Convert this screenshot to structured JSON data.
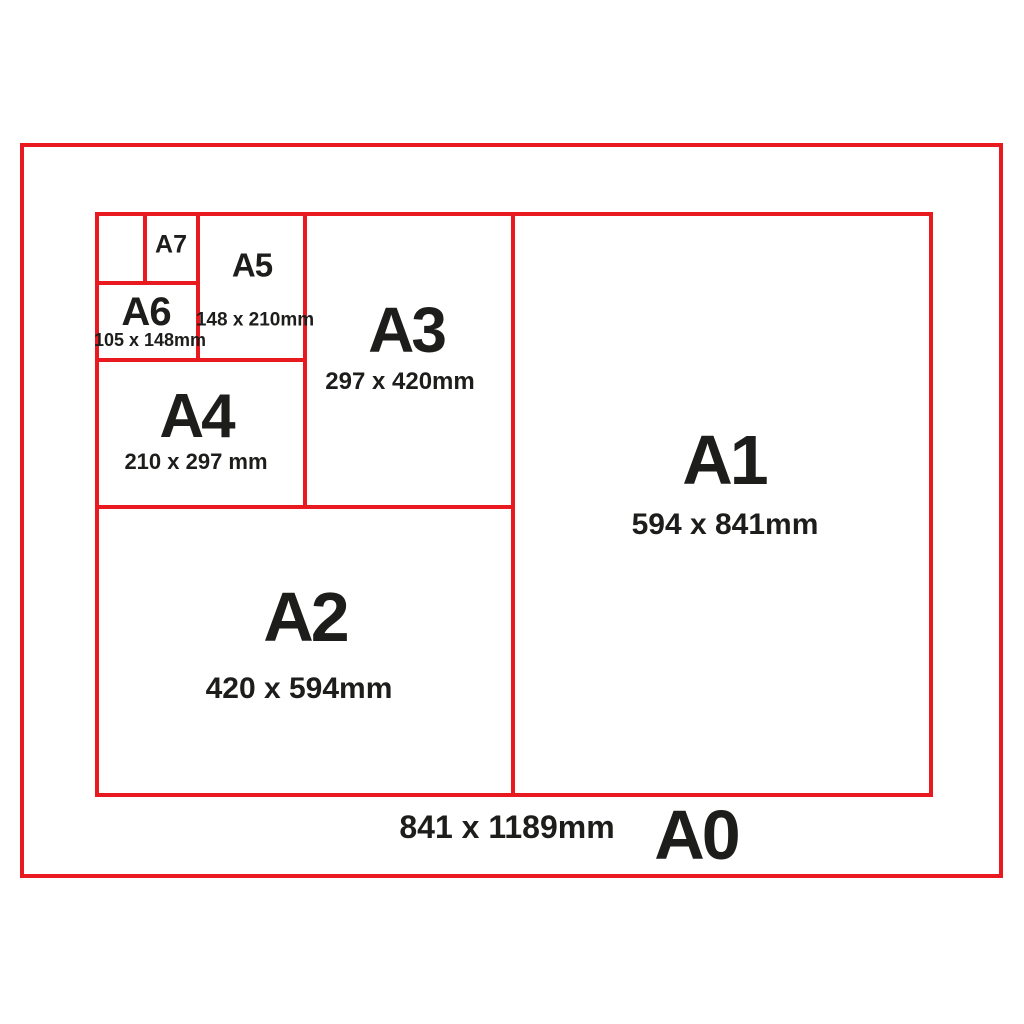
{
  "diagram": {
    "kind": "paper-size-comparison",
    "colors": {
      "line": "#e8191f",
      "text": "#1d1d1b",
      "background": "#ffffff"
    }
  },
  "sizes": [
    {
      "name": "A0",
      "dims": "841 x 1189mm"
    },
    {
      "name": "A1",
      "dims": "594 x 841mm"
    },
    {
      "name": "A2",
      "dims": "420 x 594mm"
    },
    {
      "name": "A3",
      "dims": "297 x 420mm"
    },
    {
      "name": "A4",
      "dims": "210 x 297 mm"
    },
    {
      "name": "A5",
      "dims": "148 x 210mm"
    },
    {
      "name": "A6",
      "dims": "105 x 148mm"
    },
    {
      "name": "A7",
      "dims": ""
    }
  ]
}
